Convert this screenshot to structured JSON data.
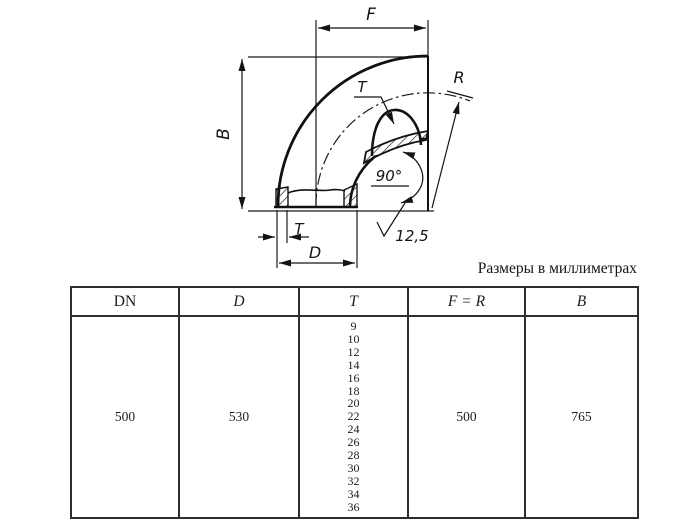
{
  "page": {
    "background": "#ffffff",
    "line_color": "#1a1a1a",
    "border_color": "#2e2e2e"
  },
  "caption": "Размеры в миллиметрах",
  "drawing": {
    "description": "section drawing of a 90-degree steel pipe elbow",
    "labels": {
      "f": "F",
      "b": "B",
      "r": "R",
      "t_section": "T",
      "t_wall": "T",
      "d": "D",
      "angle": "90°",
      "roughness": "12,5"
    }
  },
  "table": {
    "headers": [
      "DN",
      "D",
      "T",
      "F = R",
      "B"
    ],
    "row": {
      "dn": "500",
      "d": "530",
      "t_values": [
        "9",
        "10",
        "12",
        "14",
        "16",
        "18",
        "20",
        "22",
        "24",
        "26",
        "28",
        "30",
        "32",
        "34",
        "36"
      ],
      "f_r": "500",
      "b": "765"
    }
  }
}
